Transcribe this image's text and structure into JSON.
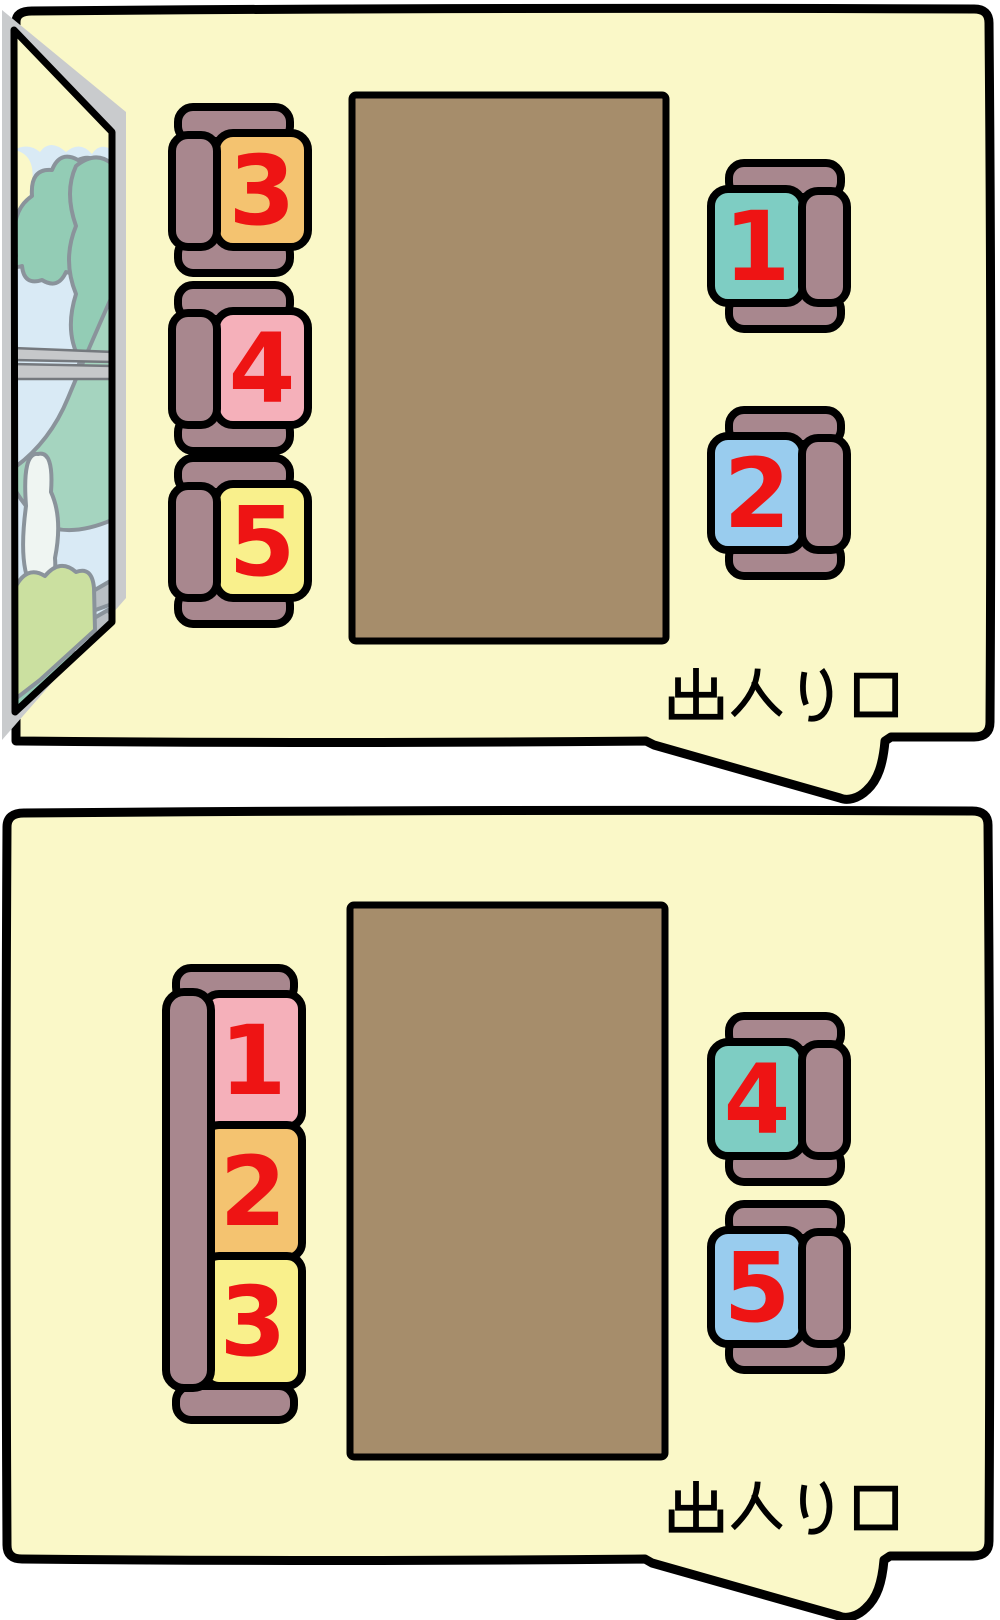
{
  "page": {
    "background": "#FFFFFF"
  },
  "colors": {
    "room": "#FAF8C8",
    "outline": "#000000",
    "table_brown": "#A68D6B",
    "seat_frame": "#A8878E",
    "number_red": "#EE1414",
    "window_frame": "#C9CBCD",
    "window_outline": "#8A939B",
    "window_sky": "#FAF8C8",
    "window_water": "#D9EAF5",
    "window_tree": "#93CCB5",
    "window_hill": "#A5D4BF",
    "window_bush": "#CBE0A0",
    "window_cloud": "#EFF5F2",
    "window_rock": "#B9BFC4"
  },
  "panels": [
    {
      "name": "room-with-window",
      "has_window": true,
      "entrance_label": "出入り口",
      "seats": [
        {
          "number": "1",
          "cushion": "#7ECDC3"
        },
        {
          "number": "2",
          "cushion": "#99CCEE"
        },
        {
          "number": "3",
          "cushion": "#F4C370"
        },
        {
          "number": "4",
          "cushion": "#F5B0BA"
        },
        {
          "number": "5",
          "cushion": "#F9F08C"
        }
      ]
    },
    {
      "name": "room-without-window",
      "has_window": false,
      "entrance_label": "出入り口",
      "seats": [
        {
          "number": "1",
          "cushion": "#F5B0BA"
        },
        {
          "number": "2",
          "cushion": "#F4C370"
        },
        {
          "number": "3",
          "cushion": "#F9F08C"
        },
        {
          "number": "4",
          "cushion": "#7ECDC3"
        },
        {
          "number": "5",
          "cushion": "#99CCEE"
        }
      ]
    }
  ]
}
